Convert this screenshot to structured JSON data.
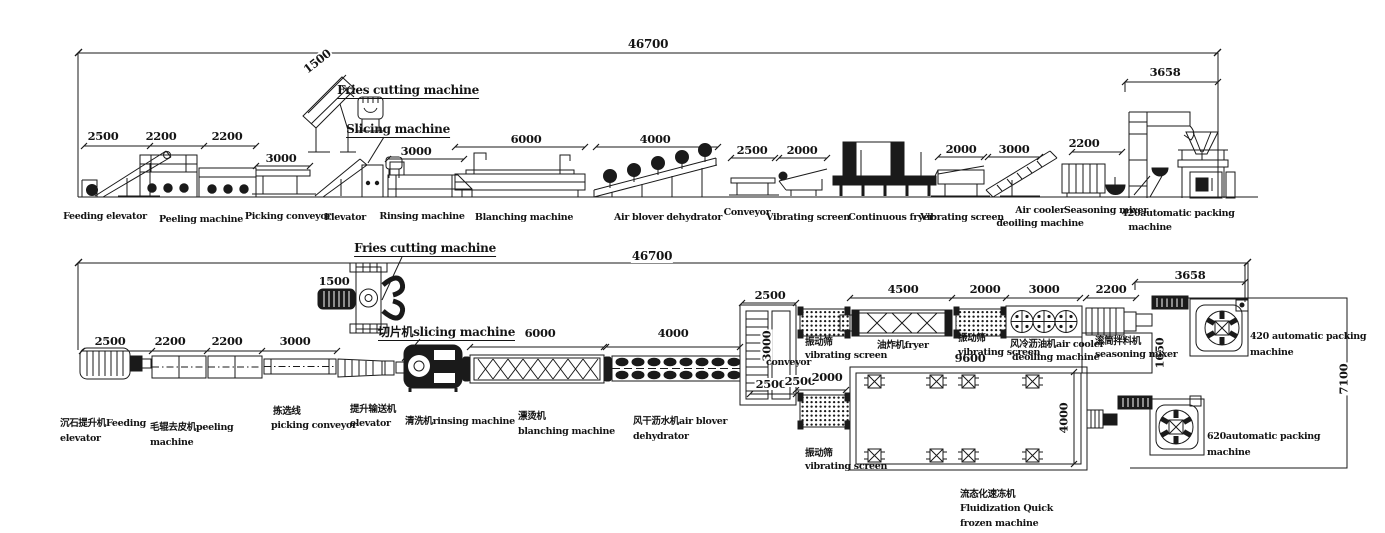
{
  "side_view": {
    "overall_dim": "46700",
    "dims": {
      "feeding": "2500",
      "peeling_1": "2200",
      "peeling_2": "2200",
      "picking": "3000",
      "fries_cutting": "1500",
      "rinsing": "3000",
      "blanching": "6000",
      "dehydrator": "4000",
      "conveyor": "2500",
      "vibrating_1": "2000",
      "vibrating_2": "2000",
      "air_cooler": "3000",
      "seasoning": "2200",
      "packing": "3658"
    },
    "labels": {
      "fries_cutting": "Fries cutting machine",
      "slicing": "Slicing machine",
      "feeding": "Feeding elevator",
      "peeling": "Peeling machine",
      "picking": "Picking conveyor",
      "elevator": "Elevator",
      "rinsing": "Rinsing machine",
      "blanching": "Blanching machine",
      "dehydrator": "Air blover dehydrator",
      "conveyor": "Conveyor",
      "vibrating_1": "Vibrating screen",
      "fryer": "Continuous fryer",
      "vibrating_2": "Vibrating screen",
      "air_cooler_1": "Air cooler",
      "air_cooler_2": "deoiling machine",
      "seasoning": "Seasoning mixer",
      "packing_1": "420automatic packing",
      "packing_2": "machine"
    }
  },
  "plan_view": {
    "overall_dim": "46700",
    "dims": {
      "feeding": "2500",
      "peeling_1": "2200",
      "peeling_2": "2200",
      "picking": "3000",
      "fries_cutting": "1500",
      "blanching": "6000",
      "dehydrator": "4000",
      "conveyor_w": "2500",
      "conveyor_l": "3000",
      "branch_1": "2500",
      "branch_2": "2500",
      "branch_3": "2000",
      "fryer": "4500",
      "vibrating_2": "2000",
      "air_cooler": "3000",
      "seasoning": "2200",
      "seasoning_w": "1650",
      "packing": "3658",
      "freezer_l": "9600",
      "freezer_w": "4000",
      "room_w": "7100"
    },
    "labels": {
      "fries_cutting": "Fries cutting machine",
      "slicing": "切片机slicing machine",
      "feeding_1": "沉石提升机Feeding",
      "feeding_2": "elevator",
      "peeling_1": "毛辊去皮机peeling",
      "peeling_2": "machine",
      "picking_1": "拣选线",
      "picking_2": "picking conveyor",
      "elevator_1": "提升输送机",
      "elevator_2": "elevator",
      "rinsing": "清洗机rinsing machine",
      "blanching_1": "漂烫机",
      "blanching_2": "blanching machine",
      "dehydrator_1": "风干沥水机air blover",
      "dehydrator_2": "dehydrator",
      "conveyor": "conveyor",
      "vibrating_1a": "振动筛",
      "vibrating_1b": "vibrating screen",
      "fryer": "油炸机fryer",
      "vibrating_2a": "振动筛",
      "vibrating_2b": "vibrating screen",
      "air_cooler_1": "风冷沥油机air cooler",
      "air_cooler_2": "deoiling machine",
      "seasoning_1": "滚筒拌料机",
      "seasoning_2": "seasoning mixer",
      "packing420_1": "420 automatic packing",
      "packing420_2": "machine",
      "vibrating_3a": "振动筛",
      "vibrating_3b": "vibrating screen",
      "freezer_1": "流态化速冻机",
      "freezer_2": "Fluidization Quick",
      "freezer_3": "frozen machine",
      "packing620_1": "620automatic packing",
      "packing620_2": "machine"
    }
  }
}
